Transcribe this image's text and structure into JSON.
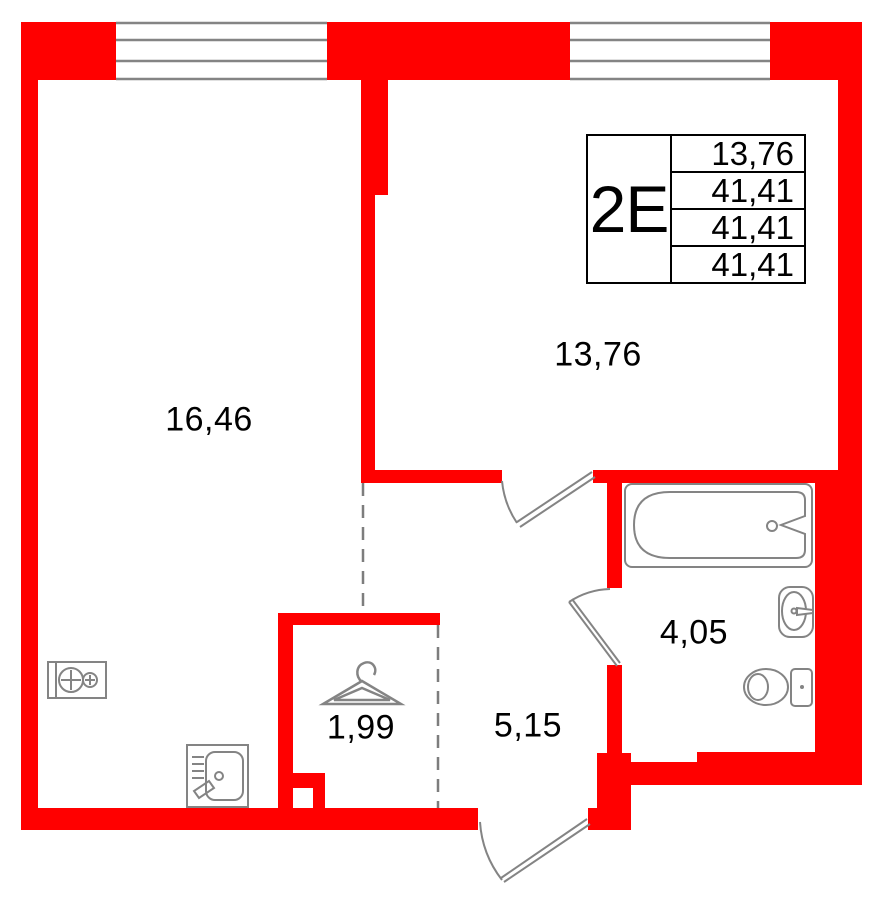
{
  "info_box": {
    "unit_type": "2E",
    "values": [
      "13,76",
      "41,41",
      "41,41",
      "41,41"
    ]
  },
  "rooms": {
    "living": "16,46",
    "bedroom": "13,76",
    "bathroom": "4,05",
    "hallway": "5,15",
    "wardrobe": "1,99"
  },
  "icons": {
    "bathtub": "bathtub-icon",
    "washbasin": "washbasin-icon",
    "toilet": "toilet-icon",
    "stove": "stove-icon",
    "kitchen_sink": "kitchen-sink-icon",
    "hanger": "hanger-icon",
    "window": "window-glazing",
    "door": "door-swing"
  },
  "colors": {
    "wall": "#FF0000",
    "fixture_line": "#848484",
    "text": "#000000"
  }
}
